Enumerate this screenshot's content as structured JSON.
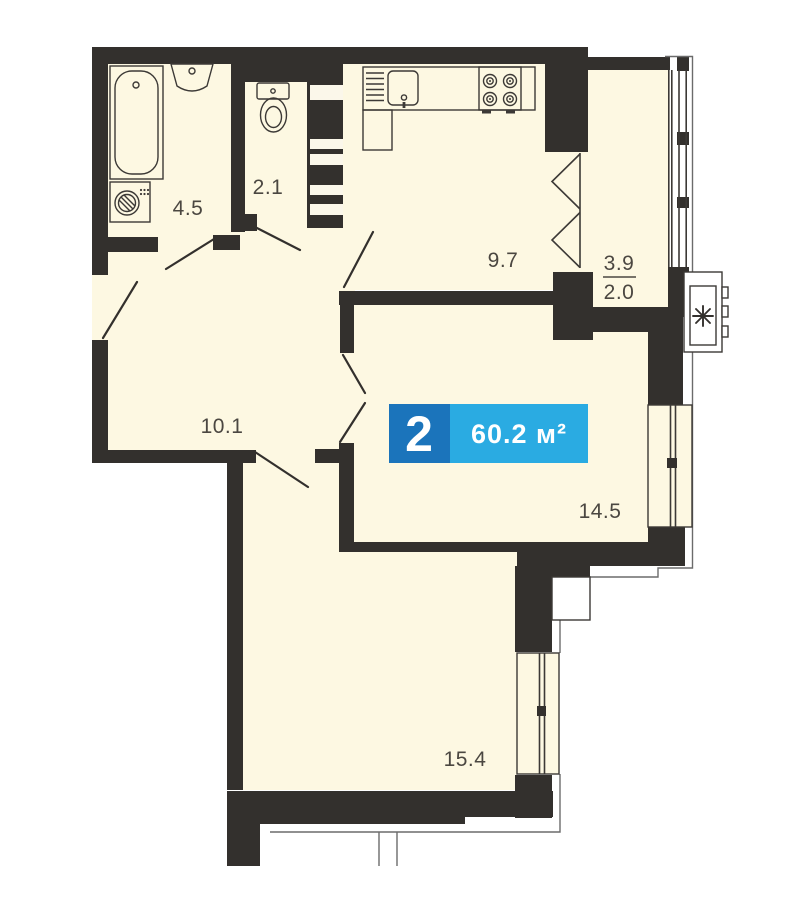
{
  "apartment": {
    "badge": {
      "rooms_count": "2",
      "total_area": "60.2 м²"
    },
    "rooms": [
      {
        "name": "bathroom",
        "area": "4.5"
      },
      {
        "name": "wc",
        "area": "2.1"
      },
      {
        "name": "kitchen",
        "area": "9.7"
      },
      {
        "name": "hallway",
        "area": "10.1"
      },
      {
        "name": "living-room",
        "area": "14.5"
      },
      {
        "name": "bedroom",
        "area": "15.4"
      }
    ],
    "balcony": {
      "area_total": "3.9",
      "area_counted": "2.0"
    },
    "colors": {
      "wall": "#33302d",
      "floor": "#fdf8e2",
      "badge_dark_blue": "#1b74bb",
      "badge_light_blue": "#2aabe2",
      "label_text": "#4b4741"
    },
    "icons": [
      "bathtub-icon",
      "washbasin-icon",
      "washing-machine-icon",
      "toilet-icon",
      "kitchen-sink-icon",
      "stove-icon",
      "vent-shaft-icon",
      "balcony-door-icon",
      "ac-unit-icon",
      "window-icon"
    ]
  }
}
